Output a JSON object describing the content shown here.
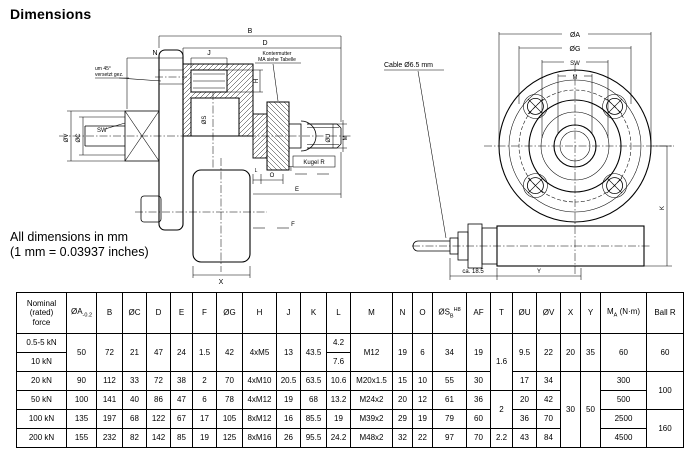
{
  "page": {
    "title": "Dimensions",
    "note_line1": "All dimensions in mm",
    "note_line2": "(1 mm = 0.03937 inches)"
  },
  "left_drawing": {
    "dim_b": "B",
    "dim_d": "D",
    "dim_j": "J",
    "dim_n": "N",
    "dim_h": "H",
    "dim_s": "ØS",
    "dim_v": "ØV",
    "dim_c": "ØC",
    "dim_sw": "SW",
    "dim_u": "ØU",
    "dim_m": "M",
    "dim_t": "T",
    "dim_o": "O",
    "dim_l": "L",
    "dim_e": "E",
    "dim_f": "F",
    "dim_x": "X",
    "note_offset1": "um 45°",
    "note_offset2": "versetzt gez.",
    "note_locknut1": "Kontermutter",
    "note_locknut2": "MA siehe Tabelle",
    "note_ball": "Kugel R"
  },
  "right_drawing": {
    "dim_a": "ØA",
    "dim_g": "ØG",
    "dim_sw": "SW",
    "dim_m": "M",
    "dim_k": "K",
    "dim_y": "Y",
    "dim_gland": "ca. 18.5",
    "note_cable": "Cable Ø6.5 mm"
  },
  "table": {
    "headers": {
      "force": "Nominal\n(rated)\nforce",
      "a_base": "ØA",
      "a_sub": "-0.2",
      "b": "B",
      "c": "ØC",
      "d": "D",
      "e": "E",
      "f": "F",
      "g": "ØG",
      "h": "H",
      "j": "J",
      "k": "K",
      "l": "L",
      "m": "M",
      "n": "N",
      "o": "O",
      "s_base": "ØS",
      "s_sub": "B",
      "s_sup": "H8",
      "af": "AF",
      "t": "T",
      "u": "ØU",
      "v": "ØV",
      "x": "X",
      "y": "Y",
      "ma_base": "M",
      "ma_sub": "A",
      "ma_rest": " (N·m)",
      "ball": "Ball R"
    },
    "r0": {
      "force": "0.5-5 kN",
      "l": "4.2"
    },
    "r1": {
      "force": "10 kN",
      "l": "7.6"
    },
    "r01": {
      "a": "50",
      "b": "72",
      "c": "21",
      "d": "47",
      "e": "24",
      "f": "1.5",
      "g": "42",
      "h": "4xM5",
      "j": "13",
      "k": "43.5",
      "m": "M12",
      "n": "19",
      "o": "6",
      "s": "34",
      "af": "19",
      "u": "9.5",
      "v": "22",
      "x": "20",
      "y": "35",
      "ma": "60",
      "ball": "60"
    },
    "r2": {
      "force": "20 kN",
      "a": "90",
      "b": "112",
      "c": "33",
      "d": "72",
      "e": "38",
      "f": "2",
      "g": "70",
      "h": "4xM10",
      "j": "20.5",
      "k": "63.5",
      "l": "10.6",
      "m": "M20x1.5",
      "n": "15",
      "o": "10",
      "s": "55",
      "af": "30",
      "u": "17",
      "v": "34",
      "ma": "300"
    },
    "r3": {
      "force": "50 kN",
      "a": "100",
      "b": "141",
      "c": "40",
      "d": "86",
      "e": "47",
      "f": "6",
      "g": "78",
      "h": "4xM12",
      "j": "19",
      "k": "68",
      "l": "13.2",
      "m": "M24x2",
      "n": "20",
      "o": "12",
      "s": "61",
      "af": "36",
      "u": "20",
      "v": "42",
      "ma": "500"
    },
    "r4": {
      "force": "100 kN",
      "a": "135",
      "b": "197",
      "c": "68",
      "d": "122",
      "e": "67",
      "f": "17",
      "g": "105",
      "h": "8xM12",
      "j": "16",
      "k": "85.5",
      "l": "19",
      "m": "M39x2",
      "n": "29",
      "o": "19",
      "s": "79",
      "af": "60",
      "u": "36",
      "v": "70",
      "ma": "2500"
    },
    "r5": {
      "force": "200 kN",
      "a": "155",
      "b": "232",
      "c": "82",
      "d": "142",
      "e": "85",
      "f": "19",
      "g": "125",
      "h": "8xM16",
      "j": "26",
      "k": "95.5",
      "l": "24.2",
      "m": "M48x2",
      "n": "32",
      "o": "22",
      "s": "97",
      "af": "70",
      "t": "2.2",
      "u": "43",
      "v": "84",
      "ma": "4500"
    },
    "merged": {
      "t012": "1.6",
      "t34": "2",
      "x25": "30",
      "y25": "50",
      "ball23": "100",
      "ball45": "160"
    }
  }
}
